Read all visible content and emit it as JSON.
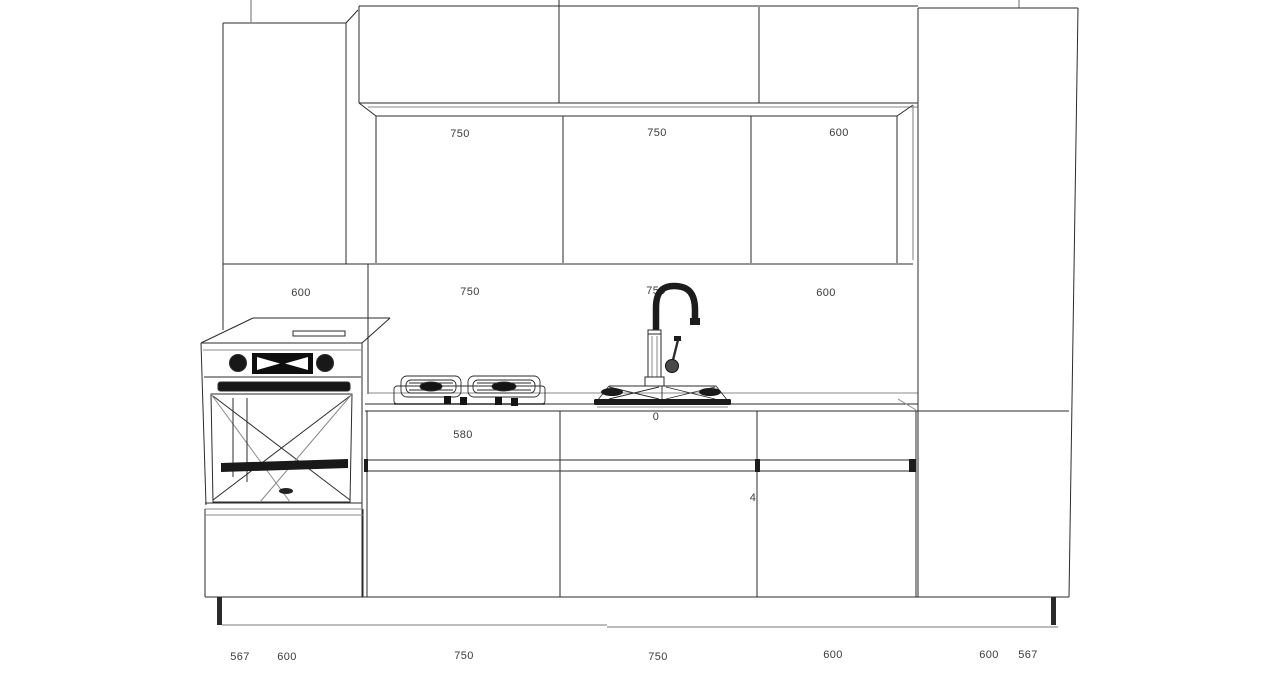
{
  "canvas": {
    "background_color": "#ffffff",
    "line_color": "#2b2b2b",
    "label_color": "#3b3b3b"
  },
  "dimensions": {
    "wall_cabinets": [
      "750",
      "750",
      "600"
    ],
    "mid_row": [
      "600",
      "750",
      "750",
      "600"
    ],
    "base_drawers": {
      "left": "580",
      "center": "0",
      "right": "4"
    },
    "bottom_row": [
      "567",
      "600",
      "750",
      "750",
      "600",
      "600",
      "567"
    ]
  },
  "icons": {
    "oven": "built-in-oven-icon",
    "cooktop": "gas-cooktop-icon",
    "sink": "kitchen-sink-icon",
    "faucet": "gooseneck-faucet-icon"
  }
}
